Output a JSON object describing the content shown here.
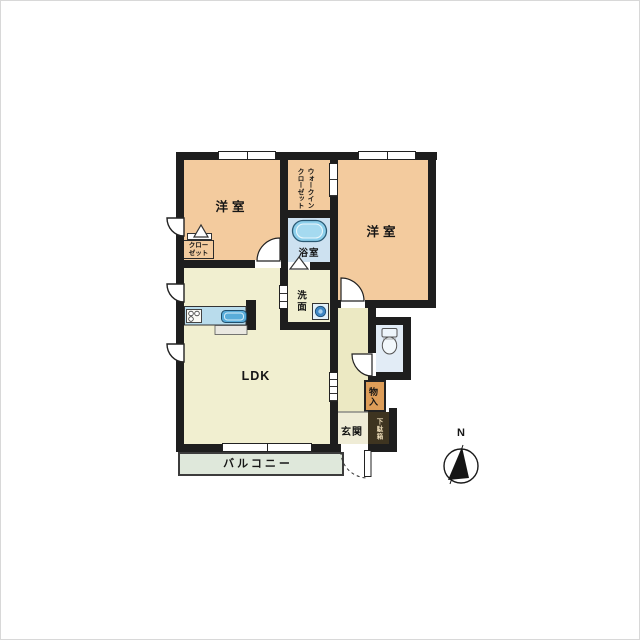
{
  "rooms": {
    "bedroom_left": "洋室",
    "bedroom_right": "洋室",
    "walkin_closet": [
      "ウォークイン",
      "クローゼット"
    ],
    "bath": "浴室",
    "washroom": "洗面",
    "closet": [
      "クロー",
      "ゼット"
    ],
    "ldk": "LDK",
    "entrance": "玄関",
    "storage": "物入",
    "shoe_cabinet": "下駄箱",
    "balcony": "バルコニー"
  },
  "compass": {
    "north": "N"
  },
  "colors": {
    "wall": "#1e1e1e",
    "bedroom": "#f3cb9e",
    "ldk": "#f1efd0",
    "hallway": "#ece9c3",
    "entrance_floor": "#efecd6",
    "bath": "#cde1f0",
    "washroom": "#e7f2fa",
    "toilet": "#e2ecf6",
    "balcony": "#dfe8db",
    "storage": "#dd9d58",
    "shoe_cabinet": "#3e3420",
    "kitchen_counter": "#b9dcec",
    "sink": "#59acd9",
    "tub": "#8ccfeb"
  }
}
